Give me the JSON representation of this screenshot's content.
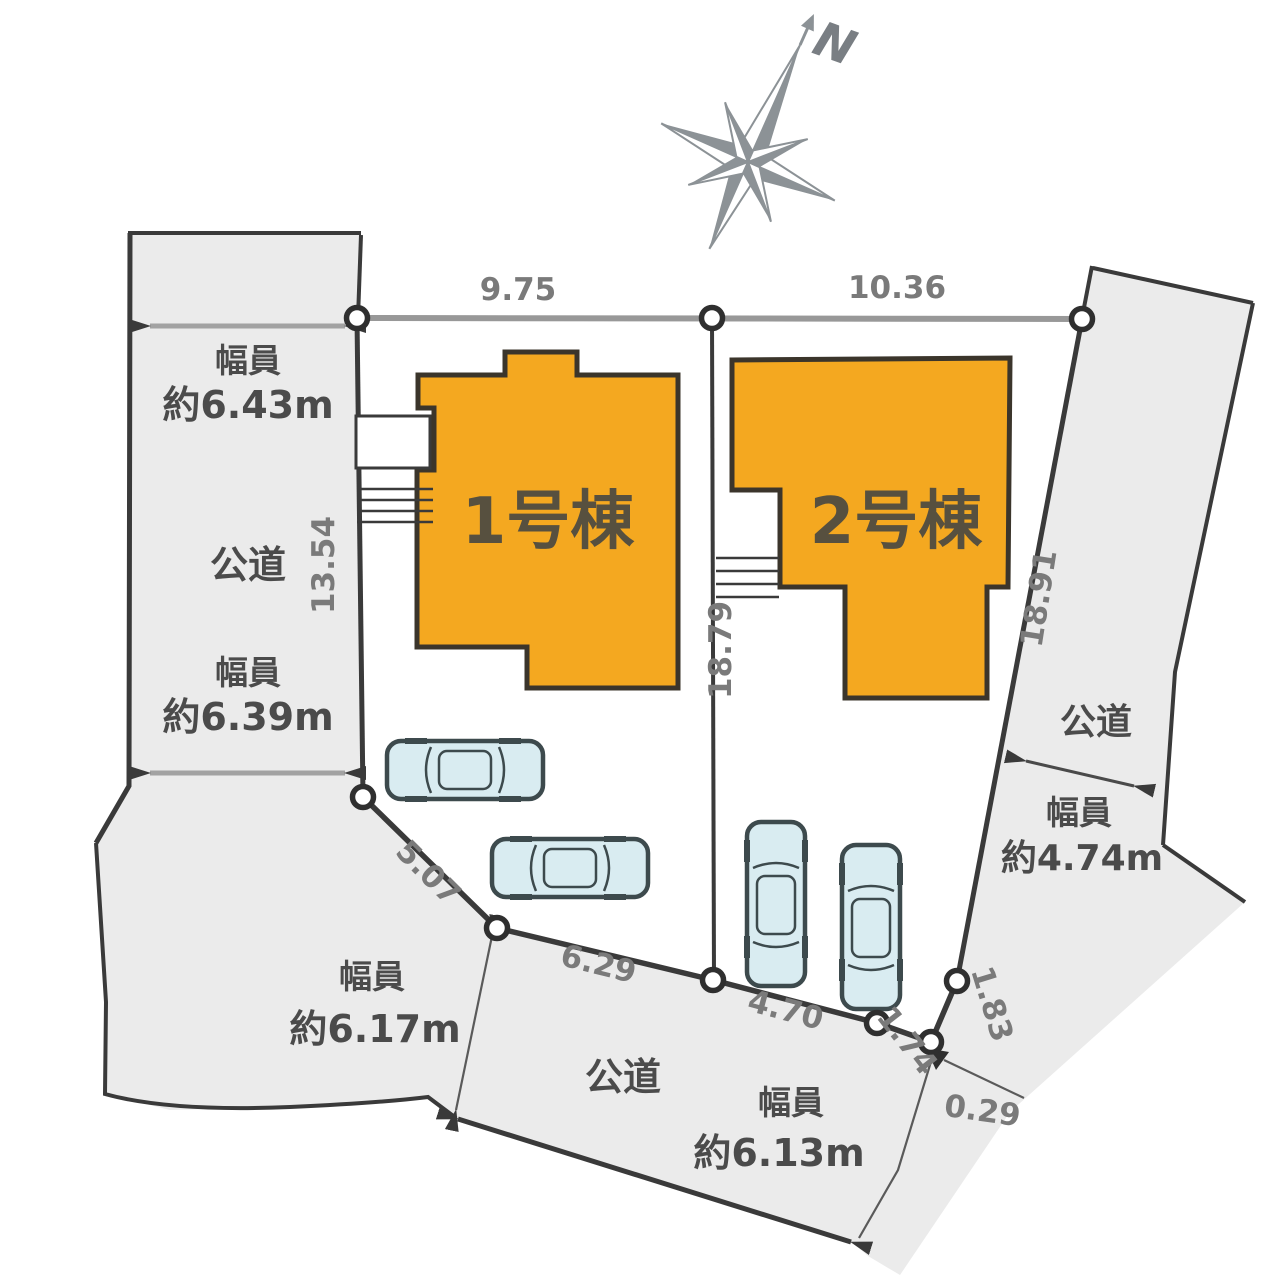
{
  "compass": {
    "north_label": "N"
  },
  "buildings": [
    {
      "label": "1号棟"
    },
    {
      "label": "2号棟"
    }
  ],
  "dims": {
    "lot1_frontage": "9.75",
    "lot2_frontage": "10.36",
    "left_depth": "13.54",
    "center_depth": "18.79",
    "right_depth": "18.91",
    "seg_sw": "5.07",
    "seg_s1": "6.29",
    "seg_s2": "4.70",
    "seg_s3": "1.74",
    "seg_s4": "1.83",
    "seg_s5": "0.29"
  },
  "roads": {
    "left": {
      "name": "公道",
      "width_top": {
        "label": "幅員",
        "value": "約6.43m"
      },
      "width_bottom": {
        "label": "幅員",
        "value": "約6.39m"
      }
    },
    "right": {
      "name": "公道",
      "width": {
        "label": "幅員",
        "value": "約4.74m"
      }
    },
    "bottom": {
      "name": "公道",
      "width": {
        "label": "幅員",
        "value": "約6.13m"
      }
    },
    "southwest": {
      "width": {
        "label": "幅員",
        "value": "約6.17m"
      }
    }
  },
  "colors": {
    "building_fill": "#F4A820",
    "building_stroke": "#3B352B",
    "road_fill": "#EBEBEB",
    "boundary_line": "#3A3A3A",
    "car_fill": "#D9ECF1",
    "car_stroke": "#3D4A4D",
    "dim_text": "#7A7A7A",
    "label_text": "#4B4B4B",
    "compass": "#8C9296"
  }
}
